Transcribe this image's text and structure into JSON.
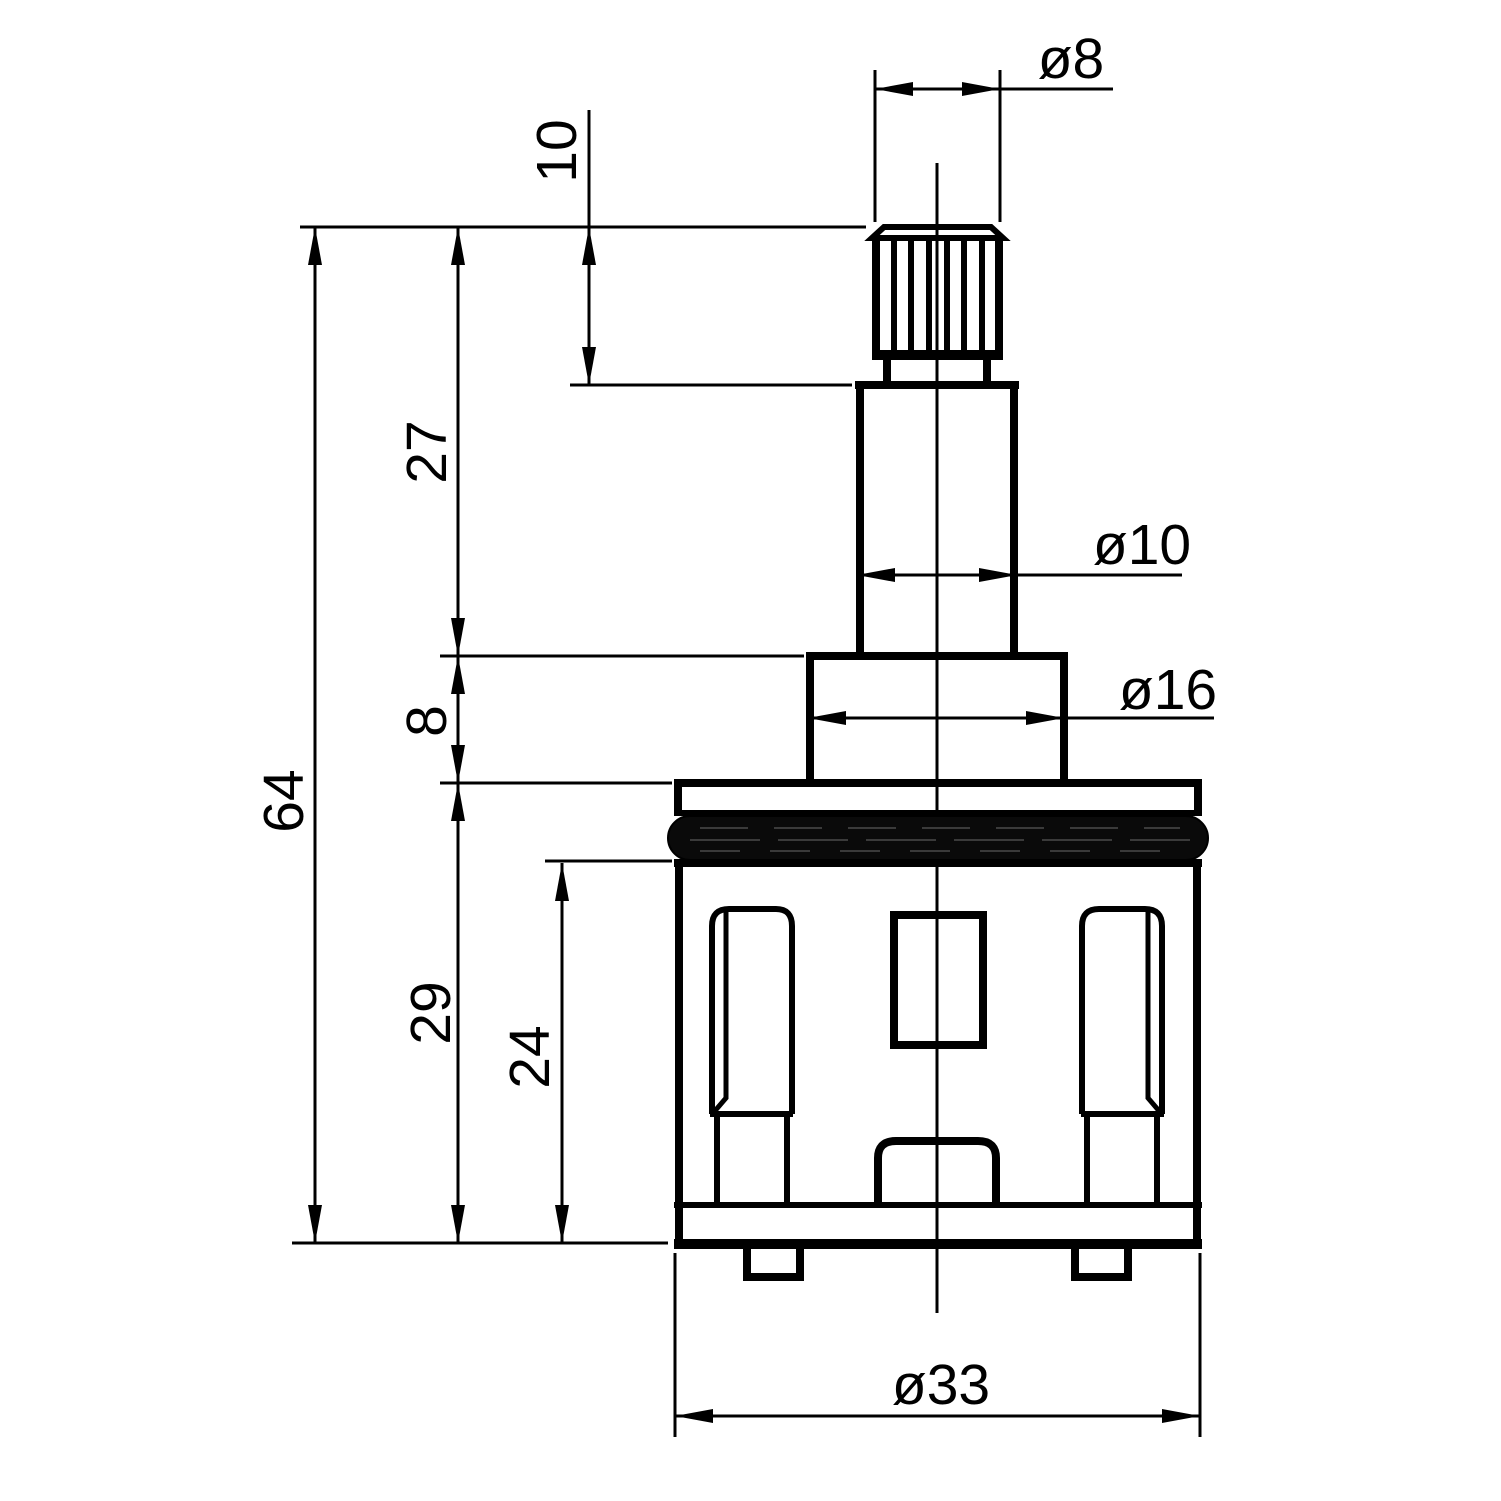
{
  "page": {
    "background_color": "#ffffff",
    "line_color": "#000000",
    "oring_color": "#0a0a0a"
  },
  "drawing": {
    "kind": "engineering-dimension-drawing",
    "parts": [
      "splined-stem",
      "stem-neck",
      "shaft",
      "step-boss",
      "flange",
      "o-ring",
      "cartridge-body",
      "left-slot",
      "right-slot",
      "center-window",
      "center-bump",
      "base-plate",
      "alignment-tabs"
    ],
    "dims": {
      "dia8": {
        "label": "ø8",
        "value": 8
      },
      "len10": {
        "label": "10",
        "value": 10
      },
      "len27": {
        "label": "27",
        "value": 27
      },
      "dia10": {
        "label": "ø10",
        "value": 10
      },
      "dia16": {
        "label": "ø16",
        "value": 16
      },
      "len8": {
        "label": "8",
        "value": 8
      },
      "len64": {
        "label": "64",
        "value": 64
      },
      "len29": {
        "label": "29",
        "value": 29
      },
      "len24": {
        "label": "24",
        "value": 24
      },
      "dia33": {
        "label": "ø33",
        "value": 33
      }
    }
  }
}
